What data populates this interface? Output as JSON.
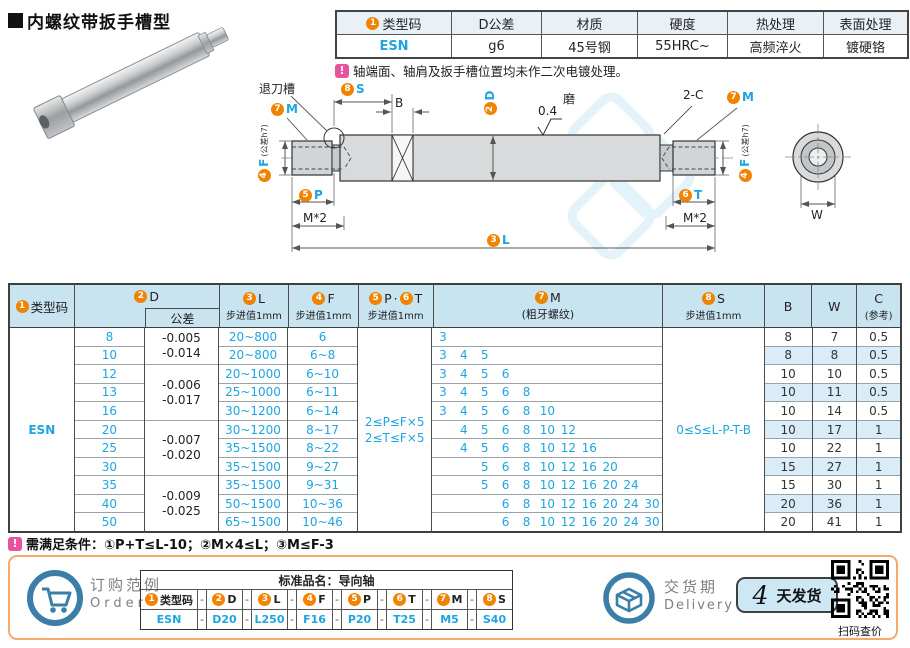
{
  "page_title": "内螺纹带扳手槽型",
  "colors": {
    "accent_orange": "#f08300",
    "link_blue": "#1ea5e0",
    "header_blue": "#c9e4f1",
    "stripe_blue": "#d9ecf7",
    "note_pink": "#e8539b",
    "box_orange": "#f5a96b"
  },
  "spec_table": {
    "type_badge": "1",
    "headers": [
      "类型码",
      "D公差",
      "材质",
      "硬度",
      "热处理",
      "表面处理"
    ],
    "values": [
      "ESN",
      "g6",
      "45号钢",
      "55HRC~",
      "高频淬火",
      "镀硬铬"
    ],
    "note": "轴端面、轴肩及扳手槽位置均未作二次电镀处理。"
  },
  "drawing": {
    "relief_groove_label": "退刀槽",
    "s_badge": "8",
    "s_letter": "S",
    "b_label": "B",
    "d_badge": "2",
    "d_letter": "D",
    "roughness": "0.4",
    "grind_label": "磨",
    "chamfer_label": "2-C",
    "m_badge": "7",
    "m_letter": "M",
    "f_badge": "4",
    "f_letter": "F",
    "f_tol": "(公差h7)",
    "p_badge": "5",
    "p_letter": "P",
    "t_badge": "6",
    "t_letter": "T",
    "l_badge": "3",
    "l_letter": "L",
    "thread_depth_label": "M*2",
    "w_label": "W"
  },
  "main_table": {
    "header": {
      "type_badge": "1",
      "type_label": "类型码",
      "d_badge": "2",
      "d_label": "D",
      "d_tol_label": "公差",
      "l_badge": "3",
      "l_label": "L",
      "step_label": "步进值1mm",
      "f_badge": "4",
      "f_label": "F",
      "p_badge": "5",
      "p_label": "P",
      "pt_sep": "·",
      "t_badge": "6",
      "t_label": "T",
      "m_badge": "7",
      "m_label": "M",
      "m_sub": "(粗牙螺纹)",
      "s_badge": "8",
      "s_label": "S",
      "b_label": "B",
      "w_label": "W",
      "c_label": "C",
      "c_sub": "(参考)"
    },
    "type_code": "ESN",
    "pt_constraint_line1": "2≤P≤F×5",
    "pt_constraint_line2": "2≤T≤F×5",
    "s_constraint": "0≤S≤L-P-T-B",
    "m_slot_values": [
      "3",
      "4",
      "5",
      "6",
      "8",
      "10",
      "12",
      "16",
      "20",
      "24",
      "30"
    ],
    "tolerance_groups": [
      {
        "span": 2,
        "line1": "-0.005",
        "line2": "-0.014"
      },
      {
        "span": 3,
        "line1": "-0.006",
        "line2": "-0.017"
      },
      {
        "span": 3,
        "line1": "-0.007",
        "line2": "-0.020"
      },
      {
        "span": 3,
        "line1": "-0.009",
        "line2": "-0.025"
      }
    ],
    "rows": [
      {
        "d": "8",
        "l": "20~800",
        "f": "6",
        "m": [
          "3"
        ],
        "b": "8",
        "w": "7",
        "c": "0.5"
      },
      {
        "d": "10",
        "l": "20~800",
        "f": "6~8",
        "m": [
          "3",
          "4",
          "5"
        ],
        "b": "8",
        "w": "8",
        "c": "0.5"
      },
      {
        "d": "12",
        "l": "20~1000",
        "f": "6~10",
        "m": [
          "3",
          "4",
          "5",
          "6"
        ],
        "b": "10",
        "w": "10",
        "c": "0.5"
      },
      {
        "d": "13",
        "l": "25~1000",
        "f": "6~11",
        "m": [
          "3",
          "4",
          "5",
          "6",
          "8"
        ],
        "b": "10",
        "w": "11",
        "c": "0.5"
      },
      {
        "d": "16",
        "l": "30~1200",
        "f": "6~14",
        "m": [
          "3",
          "4",
          "5",
          "6",
          "8",
          "10"
        ],
        "b": "10",
        "w": "14",
        "c": "0.5"
      },
      {
        "d": "20",
        "l": "30~1200",
        "f": "8~17",
        "m": [
          "4",
          "5",
          "6",
          "8",
          "10",
          "12"
        ],
        "b": "10",
        "w": "17",
        "c": "1"
      },
      {
        "d": "25",
        "l": "35~1500",
        "f": "8~22",
        "m": [
          "4",
          "5",
          "6",
          "8",
          "10",
          "12",
          "16"
        ],
        "b": "10",
        "w": "22",
        "c": "1"
      },
      {
        "d": "30",
        "l": "35~1500",
        "f": "9~27",
        "m": [
          "5",
          "6",
          "8",
          "10",
          "12",
          "16",
          "20"
        ],
        "b": "15",
        "w": "27",
        "c": "1"
      },
      {
        "d": "35",
        "l": "35~1500",
        "f": "9~31",
        "m": [
          "5",
          "6",
          "8",
          "10",
          "12",
          "16",
          "20",
          "24"
        ],
        "b": "15",
        "w": "30",
        "c": "1"
      },
      {
        "d": "40",
        "l": "50~1500",
        "f": "10~36",
        "m": [
          "6",
          "8",
          "10",
          "12",
          "16",
          "20",
          "24",
          "30"
        ],
        "b": "20",
        "w": "36",
        "c": "1"
      },
      {
        "d": "50",
        "l": "65~1500",
        "f": "10~46",
        "m": [
          "6",
          "8",
          "10",
          "12",
          "16",
          "20",
          "24",
          "30"
        ],
        "b": "20",
        "w": "41",
        "c": "1"
      }
    ]
  },
  "condition_note": "需满足条件：①P+T≤L-10；②M×4≤L；③M≤F-3",
  "order": {
    "icon_label_cn": "订购范例",
    "icon_label_en": "Order",
    "product_name": "标准品名：导向轴",
    "separator": "-",
    "fields": [
      {
        "badge": "1",
        "label": "类型码",
        "value": "ESN"
      },
      {
        "badge": "2",
        "label": "D",
        "value": "D20"
      },
      {
        "badge": "3",
        "label": "L",
        "value": "L250"
      },
      {
        "badge": "4",
        "label": "F",
        "value": "F16"
      },
      {
        "badge": "5",
        "label": "P",
        "value": "P20"
      },
      {
        "badge": "6",
        "label": "T",
        "value": "T25"
      },
      {
        "badge": "7",
        "label": "M",
        "value": "M5"
      },
      {
        "badge": "8",
        "label": "S",
        "value": "S40"
      }
    ]
  },
  "delivery": {
    "label_cn": "交货期",
    "label_en": "Delivery",
    "days": "4",
    "suffix": "天发货",
    "qr_caption": "扫码查价"
  }
}
